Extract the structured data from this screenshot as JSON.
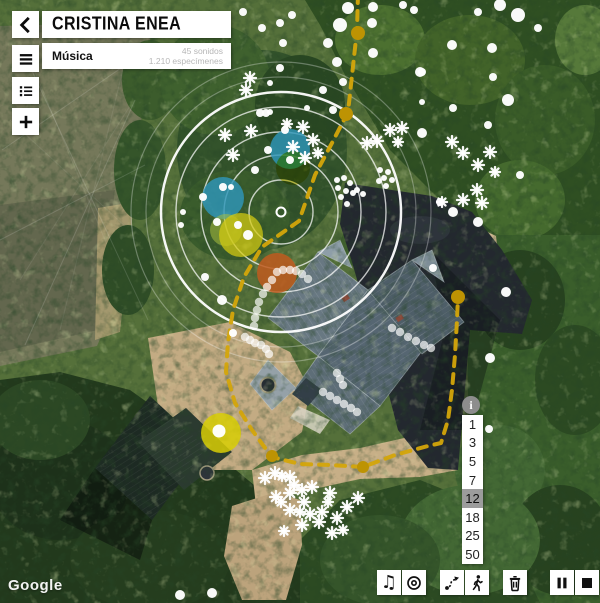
{
  "header": {
    "title": "CRISTINA ENEA",
    "subtitle": "Música",
    "stats_line1": "45 sonidos",
    "stats_line2": "1.210 especímenes"
  },
  "attribution": {
    "label": "Google"
  },
  "scale": {
    "info_label": "i",
    "values": [
      "1",
      "3",
      "5",
      "7",
      "12",
      "18",
      "25",
      "50"
    ],
    "selected": "12"
  },
  "toolbar": {
    "buttons": [
      {
        "name": "music-button",
        "icon": "music-note-icon",
        "x": 377
      },
      {
        "name": "target-button",
        "icon": "target-icon",
        "x": 402
      },
      {
        "name": "route-button",
        "icon": "route-icon",
        "x": 440
      },
      {
        "name": "walk-button",
        "icon": "walking-person-icon",
        "x": 465
      },
      {
        "name": "trash-button",
        "icon": "trash-icon",
        "x": 503
      },
      {
        "name": "pause-button",
        "icon": "pause-icon",
        "x": 550
      },
      {
        "name": "stop-button",
        "icon": "stop-icon",
        "x": 575
      }
    ]
  },
  "map_overlay": {
    "colors": {
      "route": "#d4a50a",
      "route_vertex": "#bd9303",
      "dot": "#ffffff",
      "ring": "#ffffff"
    },
    "rings": {
      "cx": 281,
      "cy": 212,
      "inner": [
        32,
        57,
        80,
        105
      ],
      "outer": 120,
      "faint": [
        135,
        150
      ],
      "center_r": 4.5
    },
    "blobs": [
      {
        "x": 290,
        "y": 149,
        "r": 20,
        "color": "#2e96ba",
        "opacity": 0.82,
        "blend": false
      },
      {
        "x": 293,
        "y": 168,
        "r": 17,
        "color": "#d6cc10",
        "opacity": 0.72,
        "blend": true
      },
      {
        "x": 223,
        "y": 198,
        "r": 21,
        "color": "#2e96ba",
        "opacity": 0.82,
        "blend": false
      },
      {
        "x": 226,
        "y": 230,
        "r": 16,
        "color": "#a7bd3e",
        "opacity": 0.55,
        "blend": false
      },
      {
        "x": 241,
        "y": 235,
        "r": 22,
        "color": "#d6cc10",
        "opacity": 0.72,
        "blend": false
      },
      {
        "x": 277,
        "y": 273,
        "r": 20,
        "color": "#bf5a1f",
        "opacity": 0.85,
        "blend": false
      },
      {
        "x": 221,
        "y": 433,
        "r": 20,
        "color": "#d8ce05",
        "opacity": 0.85,
        "blend": false
      }
    ],
    "route": {
      "dash": "9 8",
      "width": 4,
      "points": [
        [
          358,
          -6
        ],
        [
          357,
          30
        ],
        [
          348,
          112
        ],
        [
          333,
          141
        ],
        [
          315,
          175
        ],
        [
          299,
          221
        ],
        [
          262,
          247
        ],
        [
          244,
          277
        ],
        [
          233,
          310
        ],
        [
          228,
          342
        ],
        [
          226,
          372
        ],
        [
          235,
          403
        ],
        [
          252,
          430
        ],
        [
          268,
          452
        ],
        [
          276,
          458
        ],
        [
          300,
          464
        ],
        [
          330,
          465
        ],
        [
          363,
          467
        ],
        [
          395,
          455
        ],
        [
          428,
          446
        ],
        [
          441,
          443
        ],
        [
          448,
          420
        ],
        [
          452,
          390
        ],
        [
          455,
          355
        ],
        [
          457,
          320
        ],
        [
          458,
          297
        ]
      ],
      "vertices": [
        [
          358,
          33,
          7
        ],
        [
          346,
          114,
          7
        ],
        [
          458,
          297,
          7
        ],
        [
          363,
          467,
          6
        ],
        [
          272,
          456,
          6
        ]
      ]
    },
    "dots": [
      [
        243,
        12,
        4
      ],
      [
        262,
        28,
        4
      ],
      [
        348,
        8,
        6
      ],
      [
        373,
        7,
        5
      ],
      [
        403,
        5,
        4
      ],
      [
        414,
        10,
        4
      ],
      [
        340,
        25,
        7
      ],
      [
        372,
        23,
        5
      ],
      [
        292,
        15,
        4
      ],
      [
        280,
        23,
        4
      ],
      [
        328,
        43,
        5
      ],
      [
        283,
        43,
        4
      ],
      [
        373,
        53,
        5
      ],
      [
        337,
        62,
        5
      ],
      [
        280,
        68,
        4
      ],
      [
        270,
        83,
        3
      ],
      [
        343,
        82,
        4
      ],
      [
        323,
        90,
        4
      ],
      [
        422,
        72,
        4
      ],
      [
        270,
        112,
        3
      ],
      [
        333,
        110,
        4
      ],
      [
        260,
        113,
        4
      ],
      [
        307,
        108,
        3
      ],
      [
        453,
        108,
        4
      ],
      [
        422,
        102,
        3
      ],
      [
        500,
        5,
        6
      ],
      [
        518,
        15,
        7
      ],
      [
        478,
        12,
        4
      ],
      [
        538,
        28,
        4
      ],
      [
        452,
        45,
        5
      ],
      [
        492,
        48,
        5
      ],
      [
        420,
        72,
        5
      ],
      [
        493,
        77,
        4
      ],
      [
        508,
        100,
        6
      ],
      [
        488,
        125,
        4
      ],
      [
        422,
        133,
        5
      ],
      [
        520,
        175,
        4
      ],
      [
        440,
        202,
        4
      ],
      [
        453,
        212,
        5
      ],
      [
        478,
        222,
        5
      ],
      [
        266,
        113,
        4
      ],
      [
        285,
        130,
        4
      ],
      [
        290,
        160,
        4
      ],
      [
        268,
        150,
        4
      ],
      [
        255,
        170,
        4
      ],
      [
        223,
        187,
        4
      ],
      [
        231,
        187,
        3
      ],
      [
        203,
        197,
        4
      ],
      [
        217,
        222,
        4
      ],
      [
        238,
        225,
        4
      ],
      [
        248,
        235,
        5
      ],
      [
        183,
        212,
        3
      ],
      [
        181,
        225,
        3
      ],
      [
        222,
        300,
        5
      ],
      [
        233,
        333,
        4
      ],
      [
        205,
        277,
        4
      ],
      [
        337,
        180,
        3
      ],
      [
        344,
        178,
        3
      ],
      [
        350,
        183,
        3
      ],
      [
        338,
        188,
        3
      ],
      [
        346,
        191,
        3
      ],
      [
        353,
        193,
        3
      ],
      [
        341,
        197,
        3
      ],
      [
        347,
        204,
        3
      ],
      [
        357,
        190,
        3
      ],
      [
        363,
        194,
        3
      ],
      [
        380,
        170,
        3
      ],
      [
        388,
        172,
        3
      ],
      [
        384,
        178,
        3
      ],
      [
        392,
        180,
        3
      ],
      [
        379,
        181,
        3
      ],
      [
        386,
        186,
        3
      ],
      [
        433,
        268,
        4
      ],
      [
        506,
        292,
        5
      ],
      [
        490,
        358,
        5
      ],
      [
        489,
        429,
        4
      ],
      [
        180,
        595,
        5
      ],
      [
        212,
        593,
        5
      ],
      [
        219,
        431,
        6.5
      ]
    ],
    "trail_dots": [
      [
        277,
        272
      ],
      [
        283,
        270
      ],
      [
        290,
        270
      ],
      [
        296,
        271
      ],
      [
        302,
        274
      ],
      [
        308,
        279
      ],
      [
        272,
        280
      ],
      [
        267,
        287
      ],
      [
        263,
        294
      ],
      [
        259,
        302
      ],
      [
        257,
        310
      ],
      [
        255,
        318
      ],
      [
        254,
        326
      ],
      [
        245,
        337
      ],
      [
        250,
        340
      ],
      [
        255,
        343
      ],
      [
        261,
        345
      ],
      [
        266,
        349
      ],
      [
        269,
        354
      ],
      [
        392,
        328
      ],
      [
        400,
        332
      ],
      [
        408,
        337
      ],
      [
        416,
        341
      ],
      [
        424,
        345
      ],
      [
        431,
        348
      ],
      [
        337,
        373
      ],
      [
        340,
        379
      ],
      [
        343,
        385
      ],
      [
        323,
        392
      ],
      [
        330,
        396
      ],
      [
        337,
        400
      ],
      [
        344,
        404
      ],
      [
        351,
        408
      ],
      [
        357,
        412
      ]
    ],
    "flakes": [
      [
        250,
        78,
        6
      ],
      [
        246,
        90,
        6
      ],
      [
        225,
        135,
        6
      ],
      [
        233,
        155,
        6
      ],
      [
        251,
        131,
        6
      ],
      [
        287,
        124,
        5
      ],
      [
        303,
        127,
        6
      ],
      [
        313,
        140,
        6
      ],
      [
        293,
        147,
        6
      ],
      [
        305,
        158,
        6
      ],
      [
        318,
        153,
        5
      ],
      [
        367,
        143,
        6
      ],
      [
        377,
        141,
        6
      ],
      [
        390,
        130,
        6
      ],
      [
        402,
        128,
        6
      ],
      [
        398,
        142,
        5
      ],
      [
        452,
        142,
        6
      ],
      [
        463,
        153,
        6
      ],
      [
        490,
        152,
        6
      ],
      [
        478,
        165,
        6
      ],
      [
        495,
        172,
        5
      ],
      [
        477,
        190,
        6
      ],
      [
        463,
        200,
        6
      ],
      [
        482,
        203,
        6
      ],
      [
        442,
        202,
        5
      ],
      [
        265,
        478,
        6
      ],
      [
        275,
        473,
        6
      ],
      [
        282,
        476,
        5
      ],
      [
        290,
        477,
        6
      ],
      [
        294,
        485,
        6
      ],
      [
        276,
        497,
        6
      ],
      [
        281,
        502,
        5
      ],
      [
        290,
        493,
        6
      ],
      [
        302,
        490,
        6
      ],
      [
        304,
        502,
        6
      ],
      [
        290,
        510,
        6
      ],
      [
        300,
        512,
        5
      ],
      [
        312,
        487,
        6
      ],
      [
        330,
        493,
        6
      ],
      [
        328,
        502,
        5
      ],
      [
        322,
        512,
        6
      ],
      [
        310,
        514,
        6
      ],
      [
        358,
        498,
        6
      ],
      [
        347,
        507,
        6
      ],
      [
        337,
        518,
        6
      ],
      [
        319,
        522,
        6
      ],
      [
        302,
        525,
        6
      ],
      [
        332,
        533,
        6
      ],
      [
        343,
        530,
        5
      ],
      [
        284,
        531,
        5
      ]
    ],
    "faint_lines": [
      [
        20,
        45,
        148,
        320
      ],
      [
        2,
        150,
        140,
        55
      ],
      [
        25,
        345,
        135,
        100
      ],
      [
        0,
        240,
        145,
        165
      ]
    ]
  }
}
